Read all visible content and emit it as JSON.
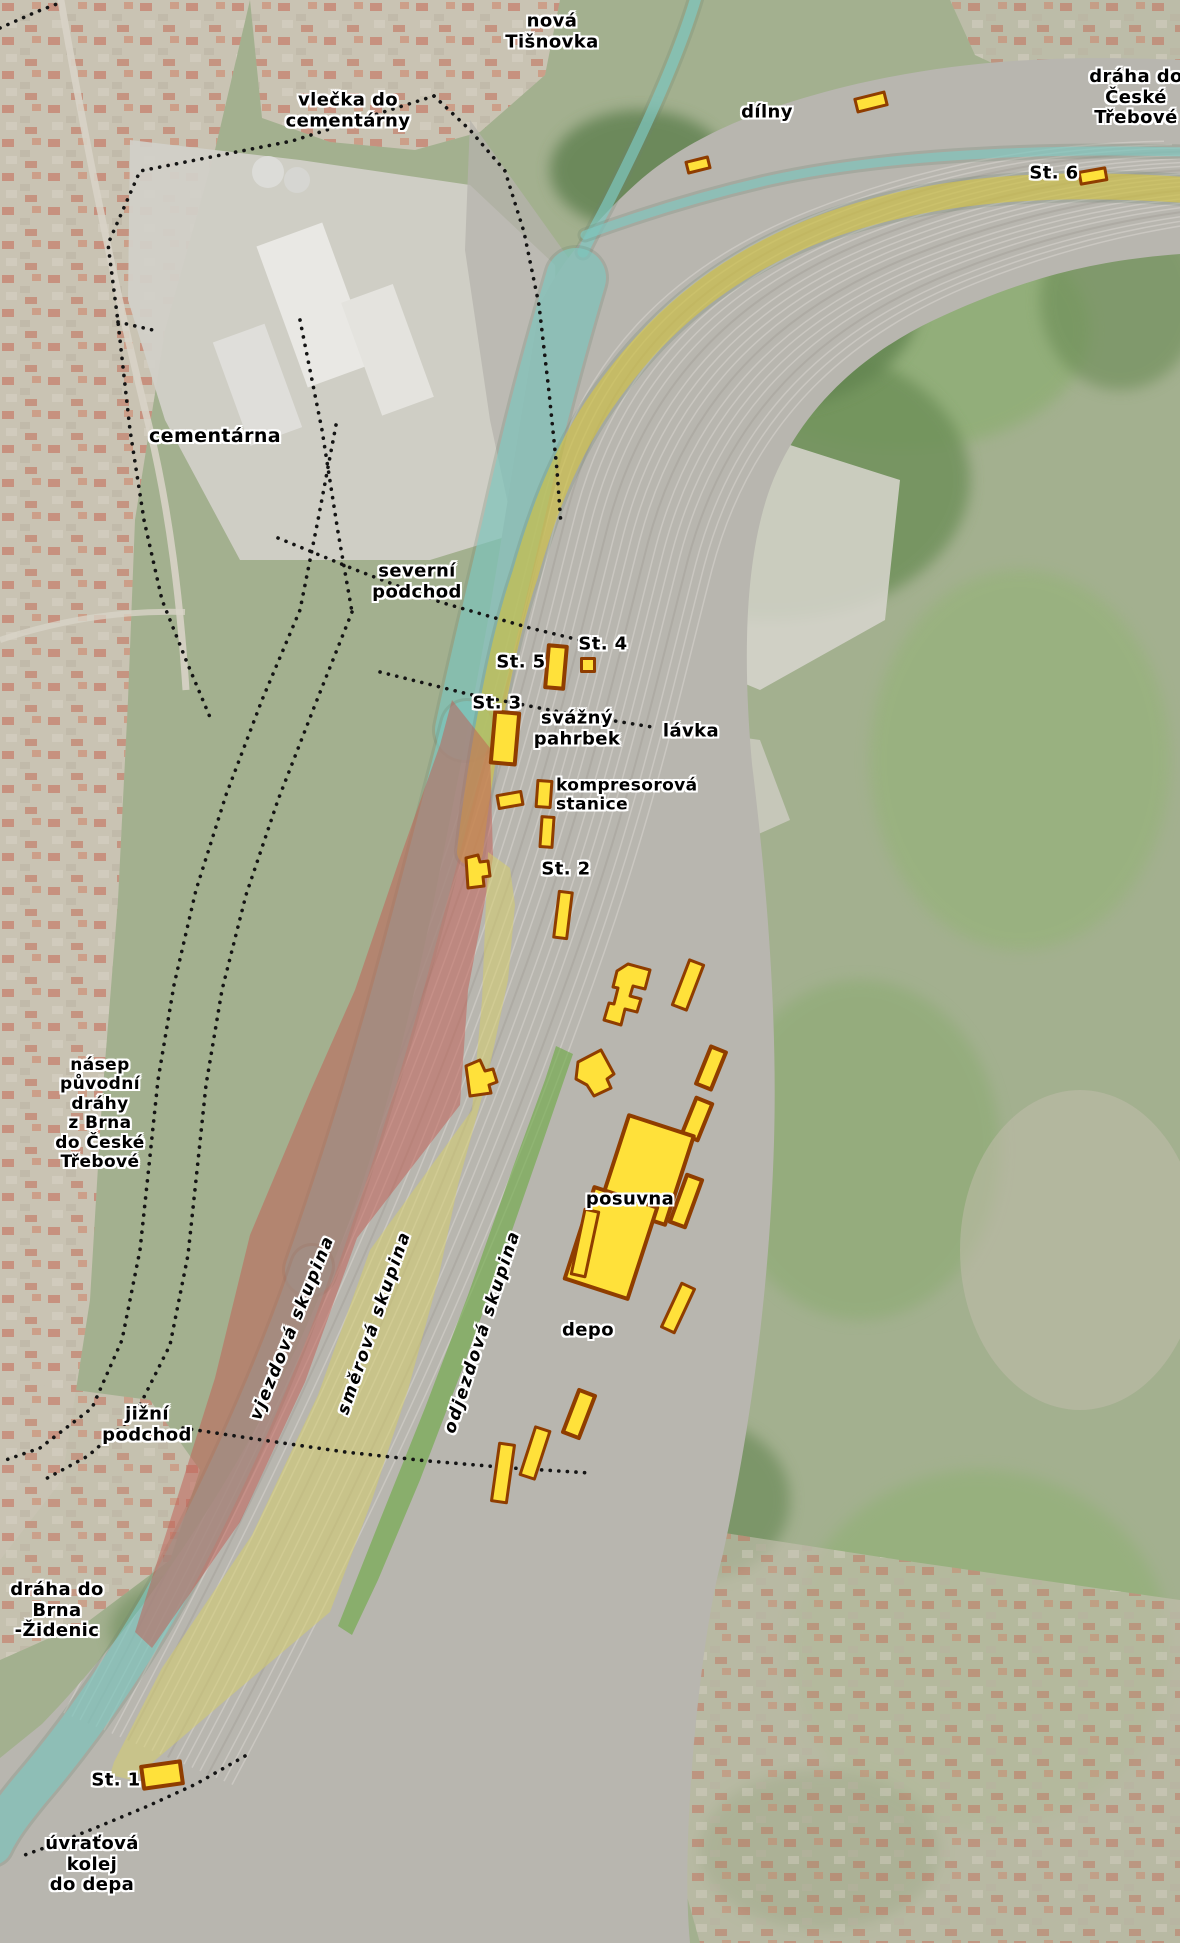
{
  "map": {
    "description": "Annotated aerial map of the Brno-Maloměřice marshalling yard",
    "colors": {
      "label_text": "#000000",
      "label_halo": "#ffffff",
      "building_fill": "#ffe13a",
      "building_stroke": "#8f3d00",
      "dotted_line": "#141414",
      "region_red": "#c25e54",
      "region_yellow": "#d8cf66",
      "region_green": "#69a93f",
      "band_cyan": "#7fcdc6",
      "band_yellow_road": "#e0cb37"
    },
    "labels": [
      {
        "id": "label-nova-tisnovka",
        "lines": [
          "nová",
          "Tišnovka"
        ],
        "x": 552,
        "y": 32
      },
      {
        "id": "label-vlecka-do-cementarny",
        "lines": [
          "vlečka do",
          "cementárny"
        ],
        "x": 348,
        "y": 111
      },
      {
        "id": "label-dilny",
        "lines": [
          "dílny"
        ],
        "x": 767,
        "y": 113
      },
      {
        "id": "label-draha-do-ceske-trebove",
        "lines": [
          "dráha do",
          "České",
          "Třebové"
        ],
        "x": 1136,
        "y": 98
      },
      {
        "id": "label-st-6",
        "lines": [
          "St. 6"
        ],
        "x": 1054,
        "y": 174
      },
      {
        "id": "label-cementarna",
        "lines": [
          "cementárna"
        ],
        "x": 215,
        "y": 437,
        "size": 19
      },
      {
        "id": "label-severni-podchod",
        "lines": [
          "severní",
          "podchod"
        ],
        "x": 417,
        "y": 582
      },
      {
        "id": "label-st-5",
        "lines": [
          "St. 5"
        ],
        "x": 521,
        "y": 663
      },
      {
        "id": "label-st-4",
        "lines": [
          "St. 4"
        ],
        "x": 603,
        "y": 645
      },
      {
        "id": "label-st-3",
        "lines": [
          "St. 3"
        ],
        "x": 497,
        "y": 704
      },
      {
        "id": "label-svazny-pahrbek",
        "lines": [
          "svážný",
          "pahrbek"
        ],
        "x": 577,
        "y": 729
      },
      {
        "id": "label-lavka",
        "lines": [
          "lávka"
        ],
        "x": 691,
        "y": 732
      },
      {
        "id": "label-kompresorova-stanice",
        "lines": [
          "kompresorová",
          "stanice"
        ],
        "x": 556,
        "y": 796,
        "size": 17,
        "align": "left"
      },
      {
        "id": "label-st-2",
        "lines": [
          "St. 2"
        ],
        "x": 566,
        "y": 870
      },
      {
        "id": "label-nasep",
        "lines": [
          "násep",
          "původní",
          "dráhy",
          "z Brna",
          "do České",
          "Třebové"
        ],
        "x": 100,
        "y": 1114,
        "size": 17
      },
      {
        "id": "label-posuvna",
        "lines": [
          "posuvna"
        ],
        "x": 630,
        "y": 1200
      },
      {
        "id": "label-vjezdova-skupina",
        "lines": [
          "vjezdová skupina"
        ],
        "x": 293,
        "y": 1328,
        "rot": -68,
        "size": 17,
        "italic": true
      },
      {
        "id": "label-smerova-skupina",
        "lines": [
          "směrová skupina"
        ],
        "x": 375,
        "y": 1323,
        "rot": -71,
        "size": 17,
        "italic": true
      },
      {
        "id": "label-odjezdova-skupina",
        "lines": [
          "odjezdová skupina"
        ],
        "x": 483,
        "y": 1332,
        "rot": -72,
        "size": 17,
        "italic": true
      },
      {
        "id": "label-depo",
        "lines": [
          "depo"
        ],
        "x": 588,
        "y": 1331
      },
      {
        "id": "label-jizni-podchod",
        "lines": [
          "jižní",
          "podchod"
        ],
        "x": 147,
        "y": 1425
      },
      {
        "id": "label-draha-do-brna-zidenic",
        "lines": [
          "dráha do",
          "Brna",
          "-Židenic"
        ],
        "x": 57,
        "y": 1611
      },
      {
        "id": "label-st-1",
        "lines": [
          "St. 1"
        ],
        "x": 116,
        "y": 1781
      },
      {
        "id": "label-uvratova-kolej-do-depa",
        "lines": [
          "úvraťová",
          "kolej",
          "do depa"
        ],
        "x": 92,
        "y": 1865
      }
    ],
    "regions": [
      {
        "id": "region-vjezdova-skupina",
        "label": "vjezdová skupina",
        "color_key": "region_red",
        "opacity": 0.52,
        "points": "452,700 490,748 493,858 468,990 460,1105 357,1238 305,1382 240,1522 152,1648 135,1632 215,1378 250,1235 310,1092 355,990 400,858 440,745"
      },
      {
        "id": "region-smerova-skupina",
        "label": "směrová skupina",
        "color_key": "region_yellow",
        "opacity": 0.5,
        "points": "488,852 510,868 515,905 508,980 488,1075 458,1185 438,1280 408,1390 372,1500 330,1612 240,1688 132,1780 110,1775 114,1762 162,1668 252,1535 318,1395 370,1250 472,1110 482,1000"
      },
      {
        "id": "region-odjezdova-skupina",
        "label": "odjezdová skupina",
        "color_key": "region_green",
        "opacity": 0.6,
        "points": "556,1046 573,1054 540,1150 500,1265 462,1370 420,1480 378,1580 352,1635 338,1626 380,1520 425,1408 468,1295 512,1170 545,1080"
      }
    ],
    "bands": [
      {
        "id": "band-tisnovka-stream-upper",
        "color_key": "band_cyan",
        "w": 11,
        "opacity": 0.65,
        "d": "M697,-6 C678,60 640,140 607,205 C596,226 588,240 583,252"
      },
      {
        "id": "band-river-east-branch",
        "color_key": "band_cyan",
        "w": 9,
        "opacity": 0.6,
        "d": "M585,235 C640,215 700,196 770,180 C880,156 1020,148 1186,152"
      },
      {
        "id": "band-tisnovka-1",
        "color_key": "band_cyan",
        "w": 60,
        "opacity": 0.6,
        "d": "M576,278 C552,360 536,420 518,500 C500,580 482,650 465,730"
      },
      {
        "id": "band-tisnovka-2",
        "color_key": "band_cyan",
        "w": 50,
        "opacity": 0.6,
        "d": "M467,726 C445,810 420,910 392,1010 C364,1110 338,1190 310,1270"
      },
      {
        "id": "band-tisnovka-3",
        "color_key": "band_cyan",
        "w": 40,
        "opacity": 0.6,
        "d": "M312,1266 C280,1360 240,1450 195,1540 C150,1630 90,1720 30,1790 C12,1812 0,1828 -8,1845"
      },
      {
        "id": "band-road",
        "color_key": "band_yellow_road",
        "w": 26,
        "opacity": 0.55,
        "d": "M1186,190 C1040,180 930,190 830,225 C740,257 670,310 617,380 C570,440 545,505 525,575 C508,625 497,680 487,735 C480,775 474,815 470,852"
      }
    ],
    "dotted_lines": [
      {
        "id": "dotted-vlecka-boundary-west",
        "d": "M434,96 L292,141 L140,171 L108,244 L118,322 L130,430 L144,520 L162,600 L186,660 L212,722"
      },
      {
        "id": "dotted-vlecka-boundary-spur",
        "d": "M118,322 L157,331"
      },
      {
        "id": "dotted-vlecka-boundary-east",
        "d": "M434,96 L470,130 L505,171 L524,232 L539,305 L549,392 L557,470 L561,525"
      },
      {
        "id": "dotted-vlecka-inner-line",
        "d": "M300,320 L322,430 L338,532 L352,612"
      },
      {
        "id": "dotted-nasep-west",
        "d": "M336,425 L318,520 L300,610 L262,700 L226,795 L196,890 L174,985 L158,1080 L148,1175 L140,1250 L122,1340 L92,1408 L40,1448 L0,1462"
      },
      {
        "id": "dotted-nasep-east",
        "d": "M352,612 L315,705 L278,800 L246,895 L222,990 L206,1085 L196,1180 L188,1255 L170,1345 L135,1415 L88,1456 L40,1482"
      },
      {
        "id": "dotted-severni-podchod",
        "d": "M278,538 L356,570 L440,602 L530,628 L600,645"
      },
      {
        "id": "dotted-lavka",
        "d": "M380,672 L468,694 L560,712 L658,728"
      },
      {
        "id": "dotted-jizni-podchod",
        "d": "M183,1428 L262,1440 L345,1452 L428,1461 L512,1468 L590,1473"
      },
      {
        "id": "dotted-uvratova-kolej",
        "d": "M245,1756 L196,1784 L148,1806 L100,1826 L55,1844 L22,1856"
      },
      {
        "id": "dotted-topleft-boundary",
        "d": "M0,28 L36,12 L62,2"
      }
    ],
    "buildings": [
      {
        "id": "building-dilny-1",
        "shape": "rect",
        "cx": 871,
        "cy": 102,
        "w": 30,
        "h": 13,
        "rot": -14
      },
      {
        "id": "building-dilny-2",
        "shape": "rect",
        "cx": 698,
        "cy": 165,
        "w": 22,
        "h": 11,
        "rot": -14
      },
      {
        "id": "building-st6",
        "shape": "rect",
        "cx": 1093,
        "cy": 176,
        "w": 26,
        "h": 12,
        "rot": -10
      },
      {
        "id": "building-st5",
        "shape": "rect",
        "cx": 556,
        "cy": 667,
        "w": 18,
        "h": 42,
        "rot": 5
      },
      {
        "id": "building-st4",
        "shape": "rect",
        "cx": 588,
        "cy": 665,
        "w": 13,
        "h": 13,
        "rot": 0
      },
      {
        "id": "building-st3",
        "shape": "rect",
        "cx": 505,
        "cy": 738,
        "w": 24,
        "h": 51,
        "rot": 5
      },
      {
        "id": "building-kompresorova",
        "shape": "rect",
        "cx": 544,
        "cy": 794,
        "w": 14,
        "h": 26,
        "rot": 4
      },
      {
        "id": "building-st2",
        "shape": "rect",
        "cx": 547,
        "cy": 832,
        "w": 12,
        "h": 30,
        "rot": 4
      },
      {
        "id": "building-small-bar",
        "shape": "rect",
        "cx": 510,
        "cy": 800,
        "w": 24,
        "h": 13,
        "rot": -10
      },
      {
        "id": "building-cross-1",
        "shape": "polygon",
        "points": "466,858 478,855 480,862 488,861 490,876 483,877 484,886 468,888"
      },
      {
        "id": "building-bar-2",
        "shape": "rect",
        "cx": 563,
        "cy": 915,
        "w": 13,
        "h": 46,
        "rot": 7
      },
      {
        "id": "building-f-hall",
        "shape": "polygon",
        "points": "628,964 650,970 645,989 633,986 630,996 641,999 637,1012 625,1009 621,1025 604,1020 609,1003 614,1004 618,988 613,987 617,971"
      },
      {
        "id": "building-bar-3",
        "shape": "rect",
        "cx": 688,
        "cy": 985,
        "w": 15,
        "h": 48,
        "rot": 21
      },
      {
        "id": "building-bar-4",
        "shape": "rect",
        "cx": 711,
        "cy": 1068,
        "w": 16,
        "h": 40,
        "rot": 22
      },
      {
        "id": "building-cross-2",
        "shape": "polygon",
        "points": "466,1066 480,1060 485,1071 493,1069 497,1082 489,1085 491,1093 470,1096"
      },
      {
        "id": "building-pentagon",
        "shape": "polygon",
        "points": "578,1062 601,1050 614,1074 607,1079 611,1088 594,1096 587,1085 576,1079"
      },
      {
        "id": "building-bar-5",
        "shape": "rect",
        "cx": 697,
        "cy": 1119,
        "w": 17,
        "h": 39,
        "rot": 22
      },
      {
        "id": "building-posuvna-hall-1",
        "shape": "rect",
        "cx": 647,
        "cy": 1170,
        "w": 68,
        "h": 93,
        "rot": 18
      },
      {
        "id": "building-posuvna-hall-2",
        "shape": "rect",
        "cx": 611,
        "cy": 1243,
        "w": 66,
        "h": 96,
        "rot": 18
      },
      {
        "id": "building-bar-6",
        "shape": "rect",
        "cx": 686,
        "cy": 1201,
        "w": 16,
        "h": 50,
        "rot": 20
      },
      {
        "id": "building-bar-7",
        "shape": "rect",
        "cx": 585,
        "cy": 1243,
        "w": 14,
        "h": 66,
        "rot": 12
      },
      {
        "id": "building-bar-8",
        "shape": "rect",
        "cx": 678,
        "cy": 1308,
        "w": 14,
        "h": 48,
        "rot": 25
      },
      {
        "id": "building-bar-9",
        "shape": "rect",
        "cx": 579,
        "cy": 1414,
        "w": 17,
        "h": 45,
        "rot": 21
      },
      {
        "id": "building-bar-10",
        "shape": "rect",
        "cx": 503,
        "cy": 1473,
        "w": 15,
        "h": 58,
        "rot": 8
      },
      {
        "id": "building-bar-11",
        "shape": "rect",
        "cx": 535,
        "cy": 1453,
        "w": 15,
        "h": 50,
        "rot": 18
      },
      {
        "id": "building-st1",
        "shape": "rect",
        "cx": 162,
        "cy": 1775,
        "w": 39,
        "h": 22,
        "rot": -8
      }
    ]
  }
}
